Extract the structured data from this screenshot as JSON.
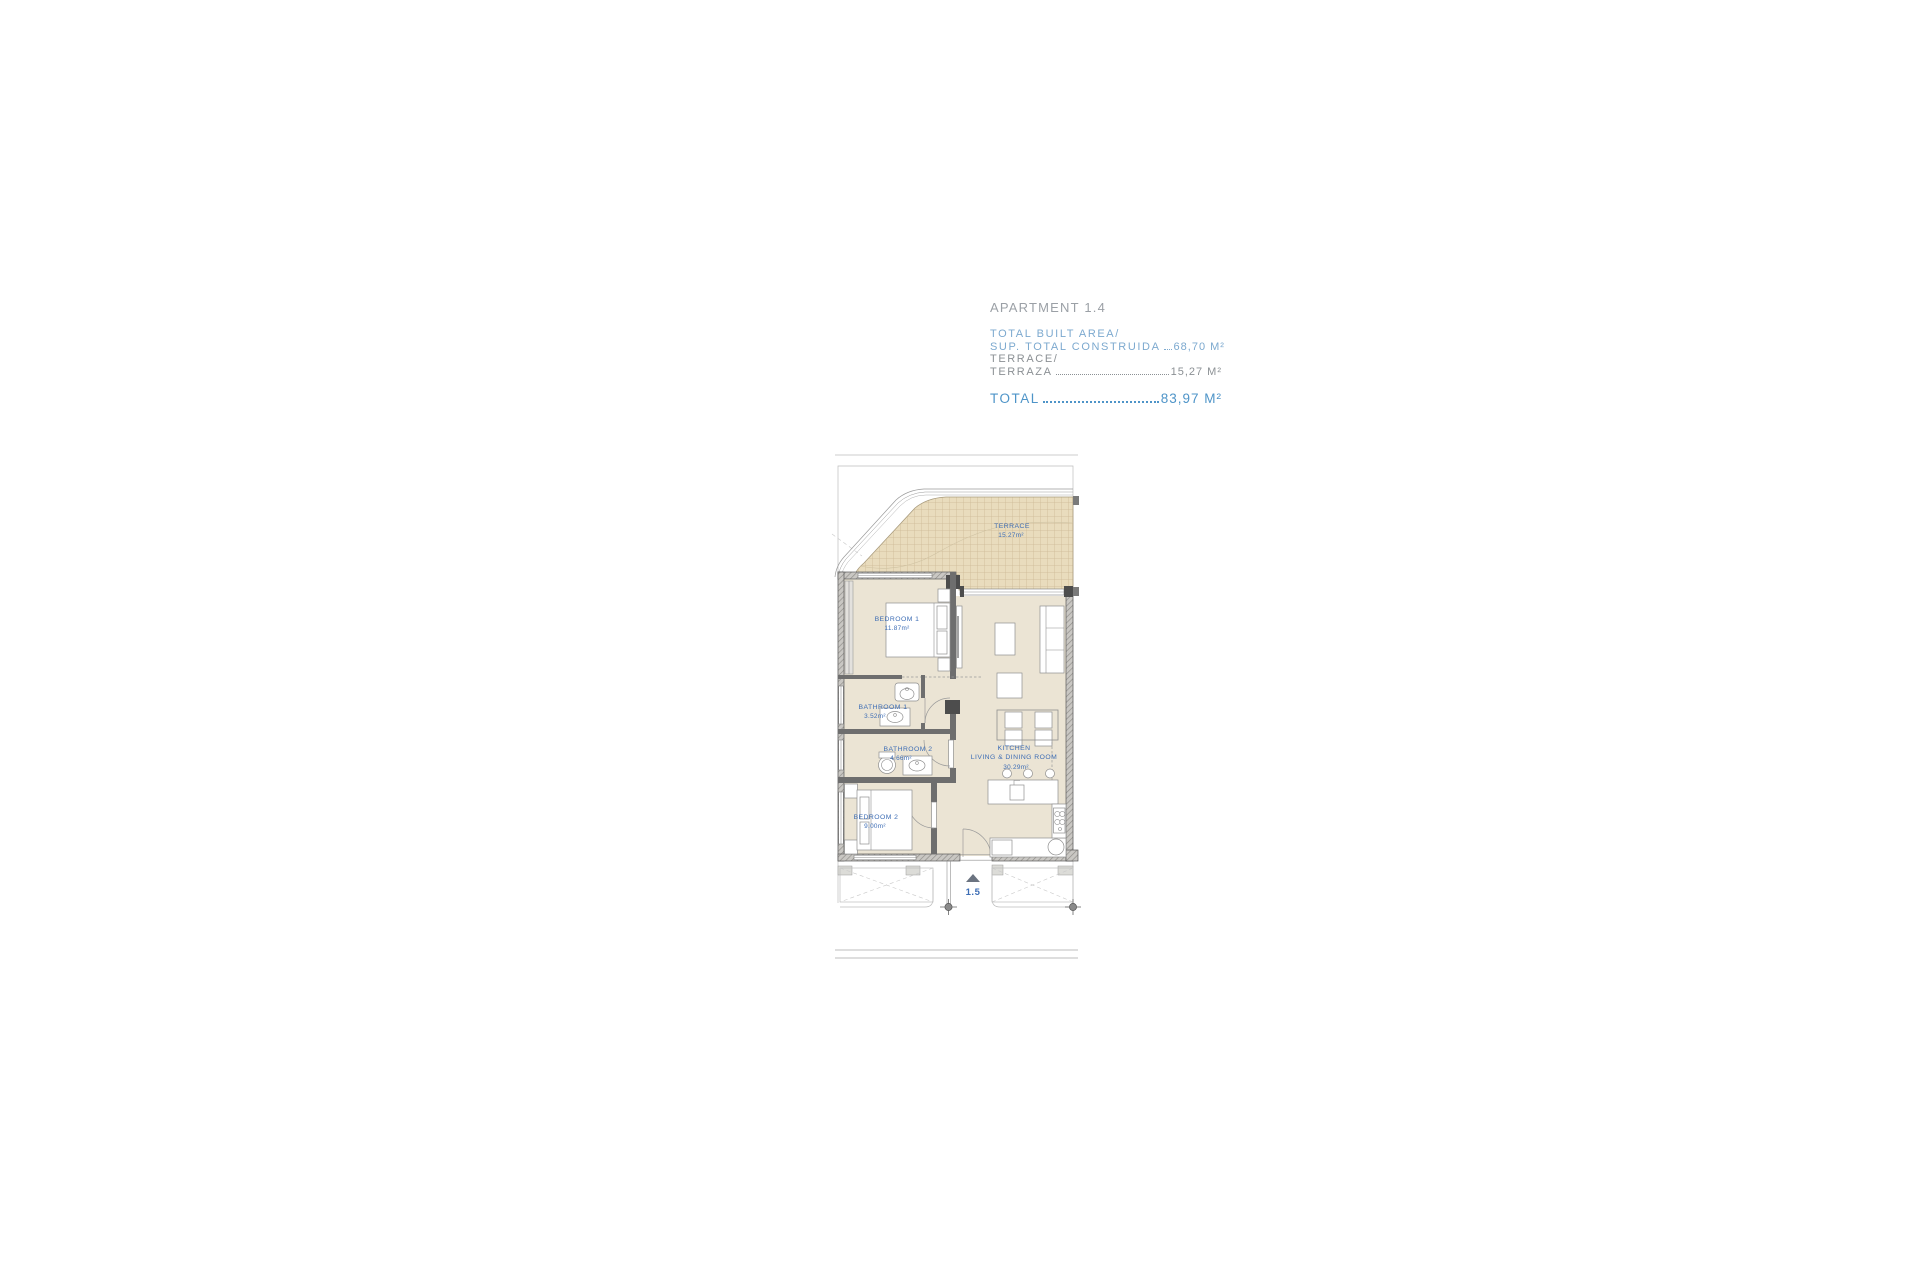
{
  "window": {
    "width": 1920,
    "height": 1280,
    "background": "#ffffff"
  },
  "header": {
    "title": "APARTMENT 1.4",
    "area_rows": [
      {
        "label": "TOTAL BUILT AREA/",
        "value": ""
      },
      {
        "label": "SUP. TOTAL CONSTRUIDA",
        "value": "68,70 M²"
      },
      {
        "label": "TERRACE/",
        "value": ""
      },
      {
        "label": "TERRAZA",
        "value": "15,27 M²"
      }
    ],
    "total": {
      "label": "TOTAL",
      "value": "83,97 M²"
    },
    "colors": {
      "title": "#9BA0A6",
      "built_area_text": "#7CA9CF",
      "terrace_text": "#8B9094",
      "total_text": "#4E94C8"
    }
  },
  "plan": {
    "unit_marker": "1.5",
    "rooms": [
      {
        "name": "TERRACE",
        "area": "15.27m²"
      },
      {
        "name": "BEDROOM 1",
        "area": "11.87m²"
      },
      {
        "name": "BATHROOM 1",
        "area": "3.52m²"
      },
      {
        "name": "BATHROOM 2",
        "area": "4.66m²"
      },
      {
        "name": "BEDROOM 2",
        "area": "9.00m²"
      },
      {
        "name": "KITCHEN",
        "name2": "LIVING & DINING ROOM",
        "area": "30.29m²"
      }
    ],
    "colors": {
      "floor": "#EBE4D4",
      "terrace_fill": "#E9DCBD",
      "terrace_grid": "#CDB995",
      "wall": "#4D4D4D",
      "room_label": "#3D6DB5",
      "entry_triangle": "#6B7380"
    }
  }
}
